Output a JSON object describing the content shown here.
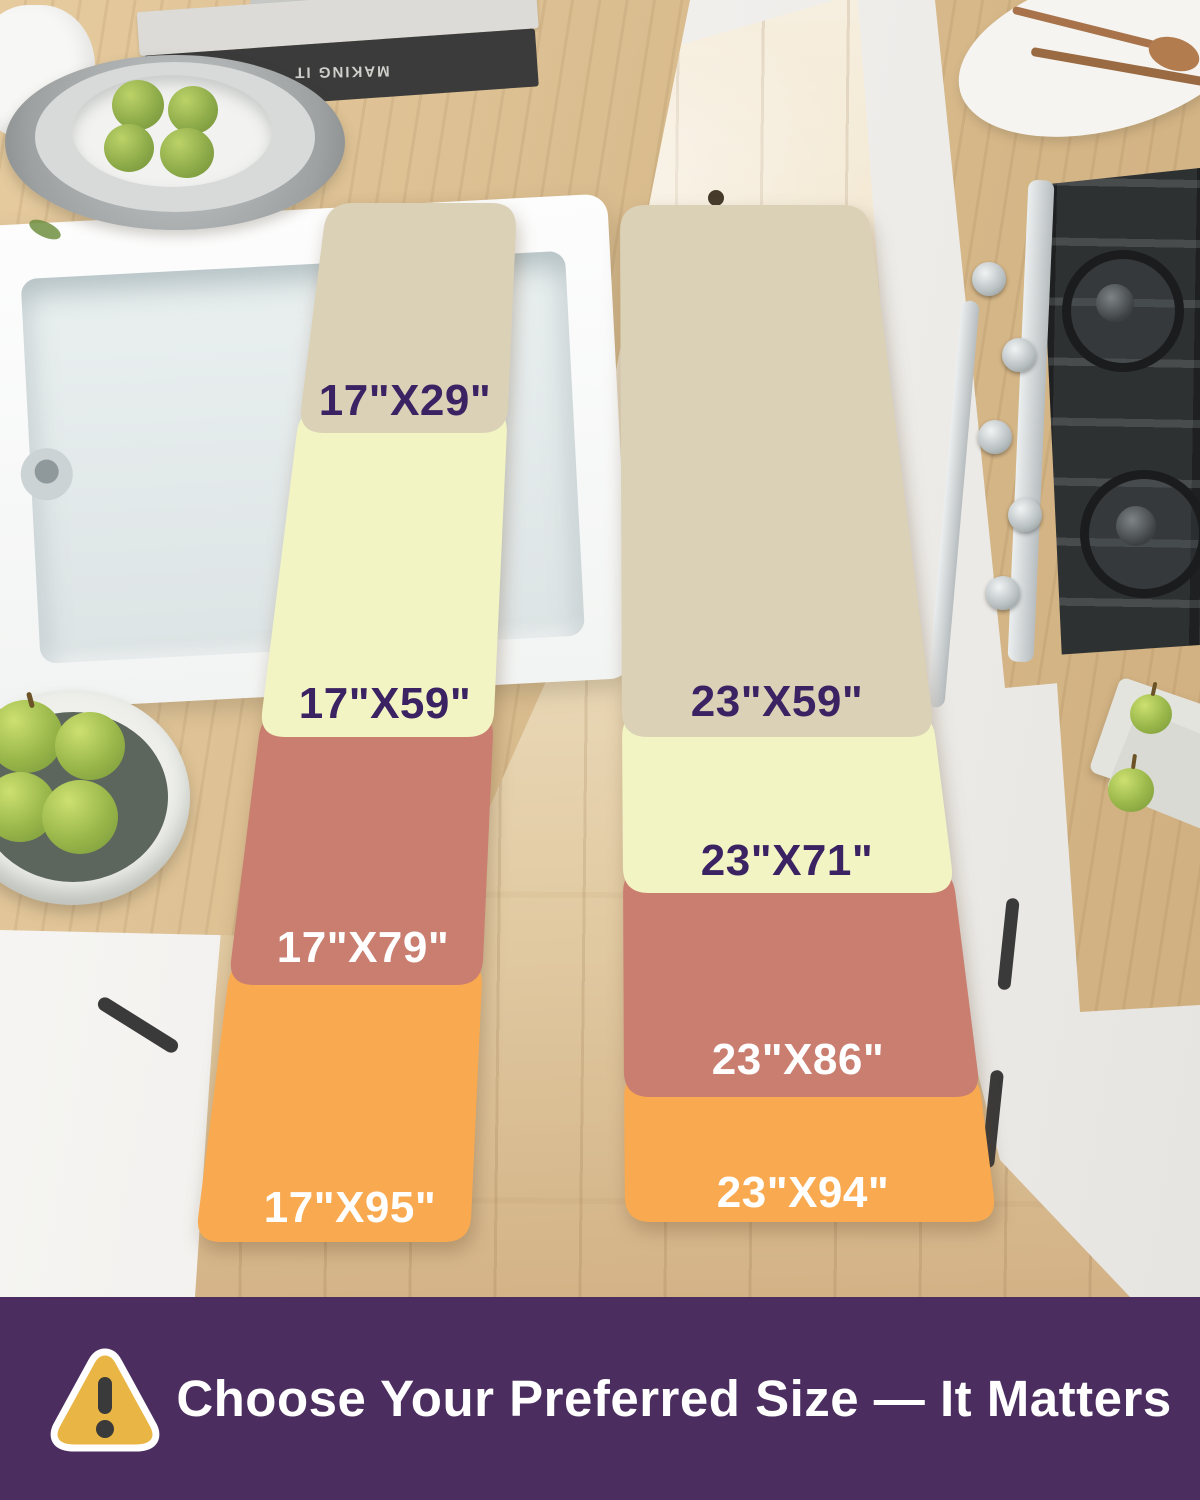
{
  "scene": {
    "width": 1200,
    "height": 1500,
    "description": "kitchen floor runner rug size comparison"
  },
  "colors": {
    "mat_beige": "#dbd1b7",
    "mat_yellow": "#f2f4c3",
    "mat_salmon": "#c97e70",
    "mat_orange": "#f9aa50",
    "label_purple": "#3b2363",
    "label_white": "#ffffff",
    "banner_bg": "#4b2d5f",
    "banner_text": "#ffffff",
    "warning_yellow": "#e9b645",
    "warning_mark": "#3a3a3a"
  },
  "size_chart": {
    "left_column": {
      "sizes": [
        {
          "label": "17\"X29\"",
          "color_name": "beige"
        },
        {
          "label": "17\"X59\"",
          "color_name": "yellow"
        },
        {
          "label": "17\"X79\"",
          "color_name": "salmon"
        },
        {
          "label": "17\"X95\"",
          "color_name": "orange"
        }
      ]
    },
    "right_column": {
      "sizes": [
        {
          "label": "23\"X59\"",
          "color_name": "beige"
        },
        {
          "label": "23\"X71\"",
          "color_name": "yellow"
        },
        {
          "label": "23\"X86\"",
          "color_name": "salmon"
        },
        {
          "label": "23\"X94\"",
          "color_name": "orange"
        }
      ]
    }
  },
  "props": {
    "book_spine_text": "MAKING IT"
  },
  "banner": {
    "icon": "warning-triangle-icon",
    "text": "Choose Your Preferred Size — It Matters"
  }
}
